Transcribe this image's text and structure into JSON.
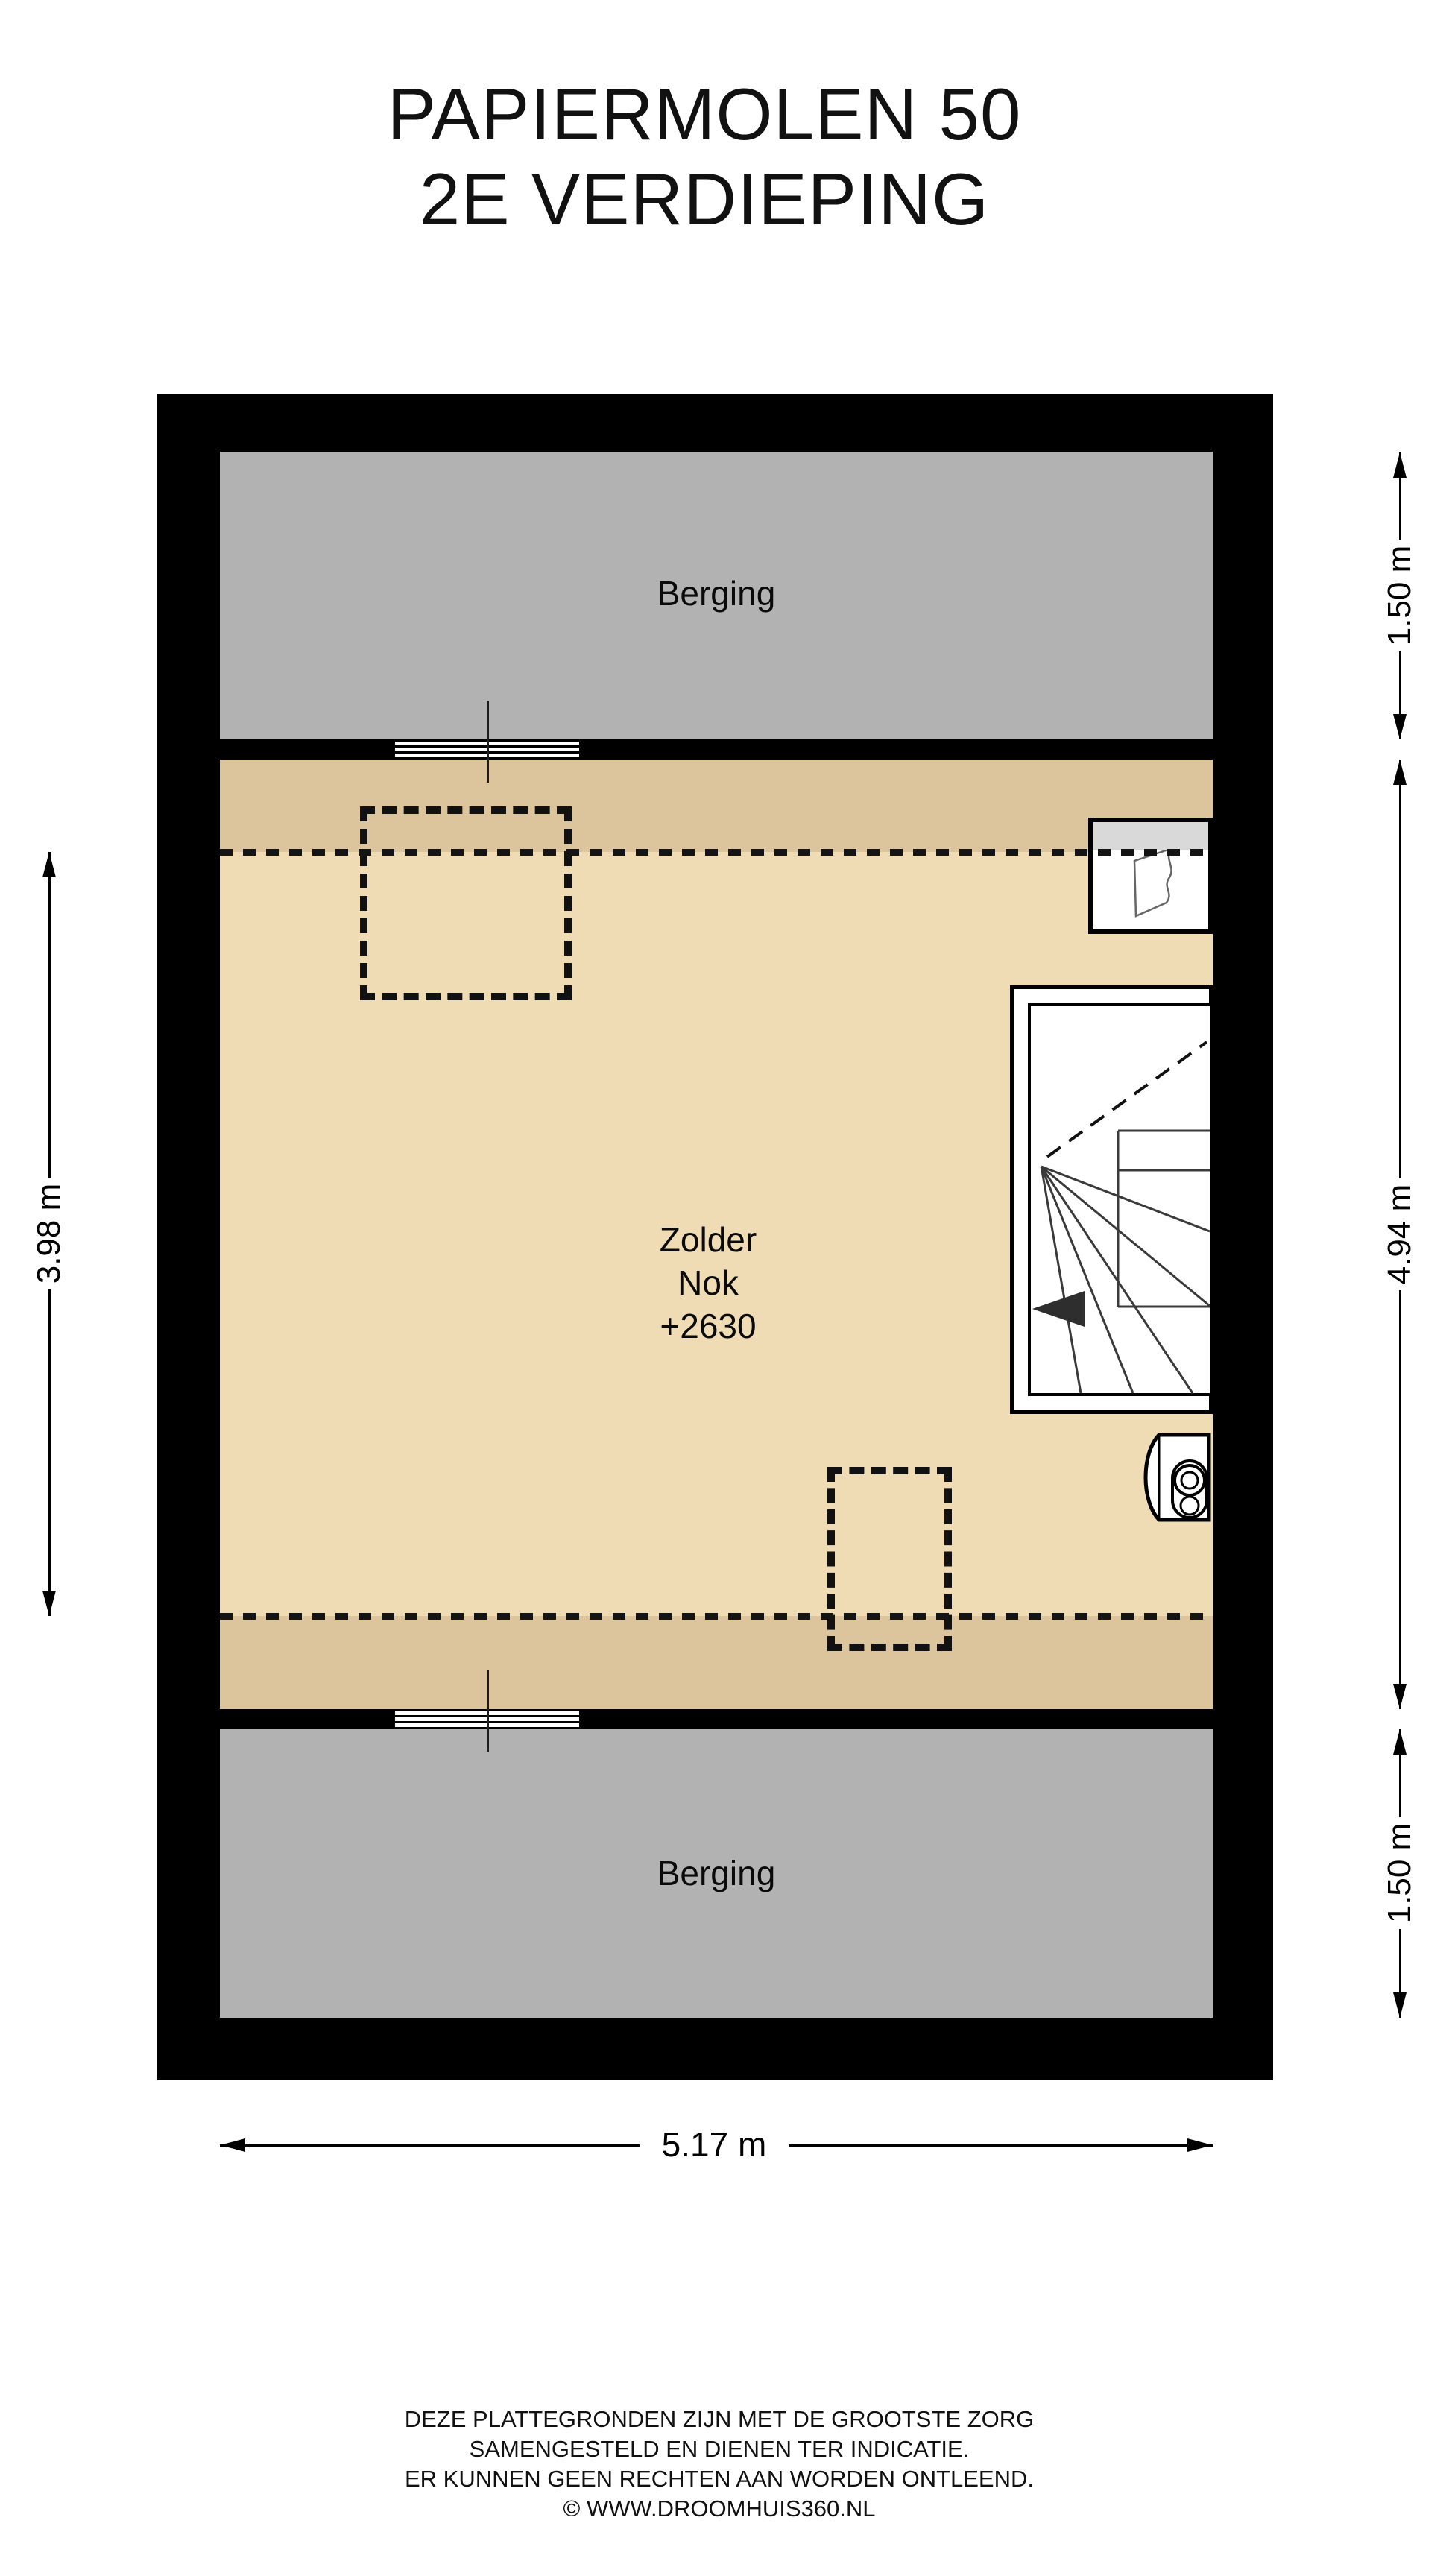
{
  "title": {
    "line1": "PAPIERMOLEN 50",
    "line2": "2E VERDIEPING"
  },
  "rooms": {
    "berging_top": "Berging",
    "berging_bottom": "Berging",
    "zolder": {
      "name": "Zolder",
      "detail1": "Nok",
      "detail2": "+2630"
    }
  },
  "dimensions": {
    "right_top": "1.50 m",
    "right_middle": "4.94 m",
    "right_bottom": "1.50 m",
    "left": "3.98 m",
    "bottom": "5.17 m"
  },
  "footer": {
    "line1": "DEZE PLATTEGRONDEN ZIJN MET DE GROOTSTE ZORG",
    "line2": "SAMENGESTELD EN DIENEN TER INDICATIE.",
    "line3": "ER KUNNEN GEEN RECHTEN AAN WORDEN ONTLEEND.",
    "line4": "© WWW.DROOMHUIS360.NL"
  },
  "icons": {
    "stairs_direction": "arrow-left",
    "dimension_arrow_vertical": "double-headed-vertical-arrow",
    "dimension_arrow_horizontal": "double-headed-horizontal-arrow"
  },
  "colors": {
    "wall": "#000000",
    "berging_fill": "#b2b2b2",
    "zolder_fill": "#f0dcb4",
    "zolder_band_fill": "#dcc49c",
    "dormer_sill_fill": "#d9d9d9",
    "stair_line": "#3a3a3a"
  }
}
